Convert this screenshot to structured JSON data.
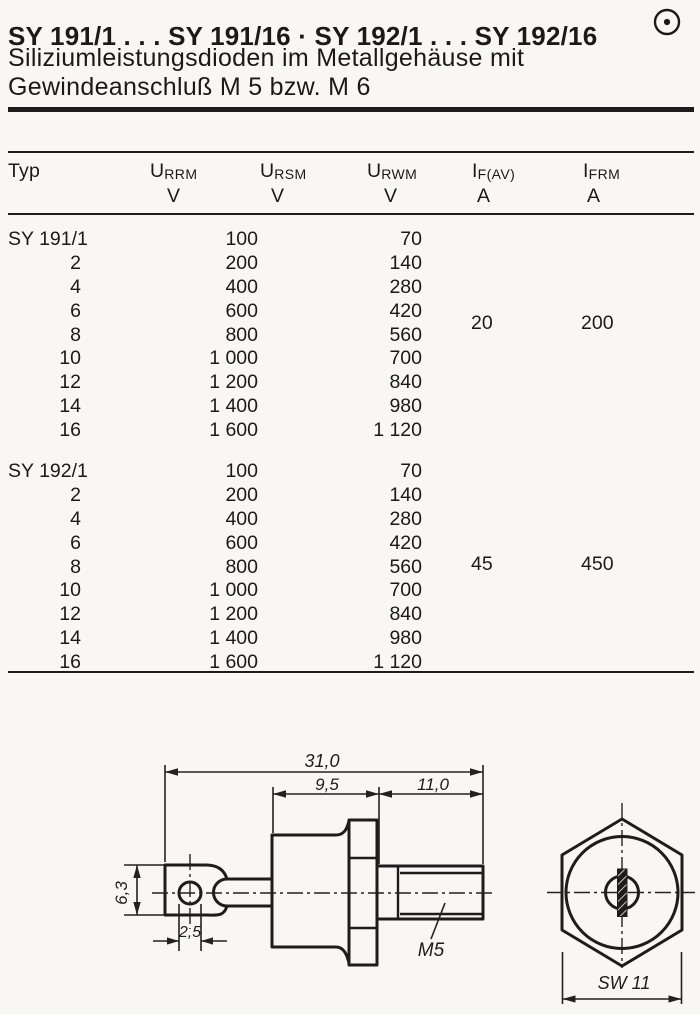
{
  "header": {
    "title": "SY 191/1 . . . SY 191/16 · SY 192/1 . . . SY 192/16",
    "subtitle_line1": "Siliziumleistungsdioden im Metallgehäuse mit",
    "subtitle_line2": "Gewindeanschluß M 5 bzw. M 6",
    "marker_icon": "circle-dot"
  },
  "table": {
    "columns": [
      {
        "label": "Typ",
        "sub": "",
        "unit": ""
      },
      {
        "label": "U",
        "sub": "RRM",
        "unit": "V"
      },
      {
        "label": "U",
        "sub": "RSM",
        "unit": "V"
      },
      {
        "label": "U",
        "sub": "RWM",
        "unit": "V"
      },
      {
        "label": "I",
        "sub": "F(AV)",
        "unit": "A"
      },
      {
        "label": "I",
        "sub": "FRM",
        "unit": "A"
      }
    ],
    "blocks": [
      {
        "series": "SY 191",
        "ifav": "20",
        "ifrm": "200",
        "rows": [
          {
            "typ": "SY 191/1",
            "urrm": "100",
            "urwm": "70"
          },
          {
            "typ": "2",
            "urrm": "200",
            "urwm": "140"
          },
          {
            "typ": "4",
            "urrm": "400",
            "urwm": "280"
          },
          {
            "typ": "6",
            "urrm": "600",
            "urwm": "420"
          },
          {
            "typ": "8",
            "urrm": "800",
            "urwm": "560"
          },
          {
            "typ": "10",
            "urrm": "1 000",
            "urwm": "700"
          },
          {
            "typ": "12",
            "urrm": "1 200",
            "urwm": "840"
          },
          {
            "typ": "14",
            "urrm": "1 400",
            "urwm": "980"
          },
          {
            "typ": "16",
            "urrm": "1 600",
            "urwm": "1 120"
          }
        ]
      },
      {
        "series": "SY 192",
        "ifav": "45",
        "ifrm": "450",
        "rows": [
          {
            "typ": "SY 192/1",
            "urrm": "100",
            "urwm": "70"
          },
          {
            "typ": "2",
            "urrm": "200",
            "urwm": "140"
          },
          {
            "typ": "4",
            "urrm": "400",
            "urwm": "280"
          },
          {
            "typ": "6",
            "urrm": "600",
            "urwm": "420"
          },
          {
            "typ": "8",
            "urrm": "800",
            "urwm": "560"
          },
          {
            "typ": "10",
            "urrm": "1 000",
            "urwm": "700"
          },
          {
            "typ": "12",
            "urrm": "1 200",
            "urwm": "840"
          },
          {
            "typ": "14",
            "urrm": "1 400",
            "urwm": "980"
          },
          {
            "typ": "16",
            "urrm": "1 600",
            "urwm": "1 120"
          }
        ]
      }
    ]
  },
  "drawings": {
    "side_view": {
      "dim_overall": "31,0",
      "dim_body": "9,5",
      "dim_thread": "11,0",
      "dim_lug_width": "6,3",
      "dim_hole": "2,5",
      "thread_label": "M5"
    },
    "front_view": {
      "dim_across_flats": "SW 11"
    }
  }
}
